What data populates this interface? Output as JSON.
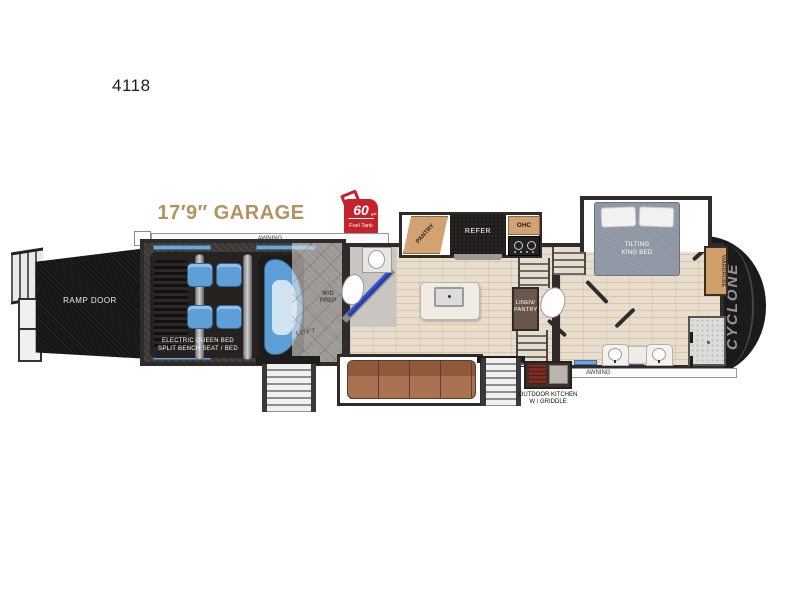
{
  "model_number": "4118",
  "garage_title": "17′9″ GARAGE",
  "fuel_tank": {
    "capacity": "60",
    "unit": "gal",
    "label": "Fuel Tank"
  },
  "labels": {
    "awning_top": "AWNING",
    "awning_bottom": "AWNING",
    "ramp_door": "RAMP DOOR",
    "electric_bed_line1": "ELECTRIC QUEEN BED",
    "electric_bed_line2": "SPLIT BENCH SEAT / BED",
    "wd_prep_line1": "W/D",
    "wd_prep_line2": "PREP",
    "loft": "LOFT",
    "pantry": "PANTRY",
    "refer": "REFER",
    "ohc": "OHC",
    "linen_line1": "LINEN/",
    "linen_line2": "PANTRY",
    "tilting_bed_line1": "TILTING",
    "tilting_bed_line2": "KING BED",
    "wardrobe": "WARDROBE",
    "brand": "CYCLONE",
    "outdoor_kitchen_line1": "OUTDOOR KITCHEN",
    "outdoor_kitchen_line2": "W / GRIDDLE"
  },
  "colors": {
    "garage_title_tan": "#b3925e",
    "fuel_tank_red": "#c5232b",
    "cushion_blue": "#5f9fd8",
    "sofa_brown": "#a06a48",
    "floor_tan": "#e9decd",
    "garage_floor_dark": "#46413f",
    "wall_dark": "#2e2b2a",
    "cabinet_tan": "#d2a272",
    "front_cap_black": "#1b1b1b",
    "shower_door_blue": "#2743c9"
  }
}
